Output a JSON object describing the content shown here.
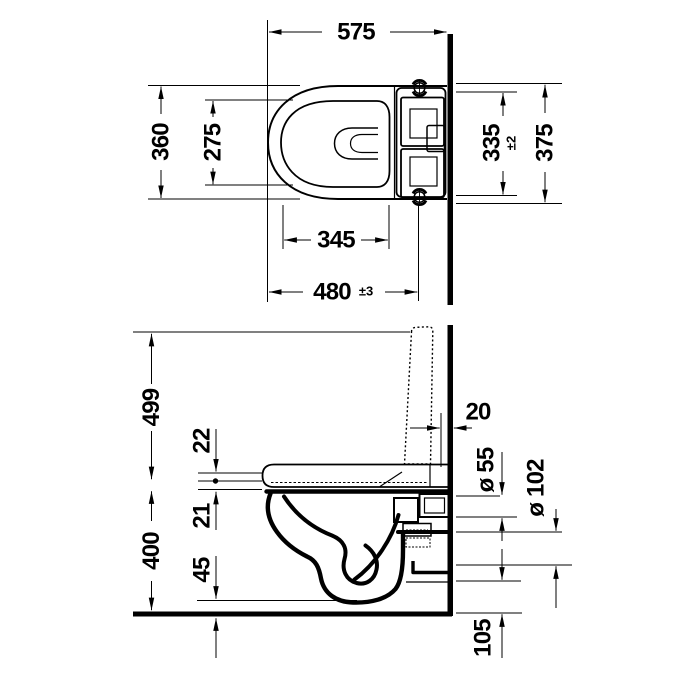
{
  "drawing": {
    "background": "#ffffff",
    "line_color": "#000000",
    "top_view": {
      "overall_length": "575",
      "outer_width": "360",
      "inner_width": "275",
      "seat_opening_length": "345",
      "front_to_fixing_holes": "480",
      "front_to_fixing_holes_tol": "±3",
      "fixing_span": "335",
      "fixing_span_tol": "±2",
      "rear_width": "375"
    },
    "side_view": {
      "open_lid_height": "499",
      "lid_to_wall_gap": "20",
      "seat_upper_offset": "22",
      "seat_lower_offset": "21",
      "rim_height": "400",
      "underside_front_clearance": "45",
      "outlet_diameter_small": "ø 55",
      "outlet_diameter_large": "ø 102",
      "outlet_bottom_height": "105"
    }
  }
}
